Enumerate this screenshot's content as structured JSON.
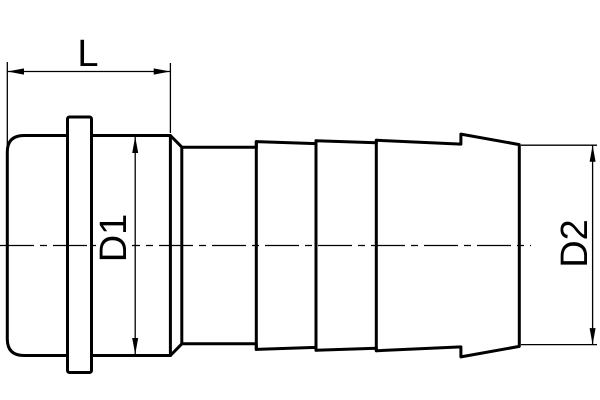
{
  "drawing": {
    "type": "technical-dimension-drawing",
    "subject": "hose barb fitting side view",
    "labels": {
      "length": "L",
      "diameter1": "D1",
      "diameter2": "D2"
    },
    "colors": {
      "line": "#000000",
      "background": "#ffffff"
    }
  }
}
